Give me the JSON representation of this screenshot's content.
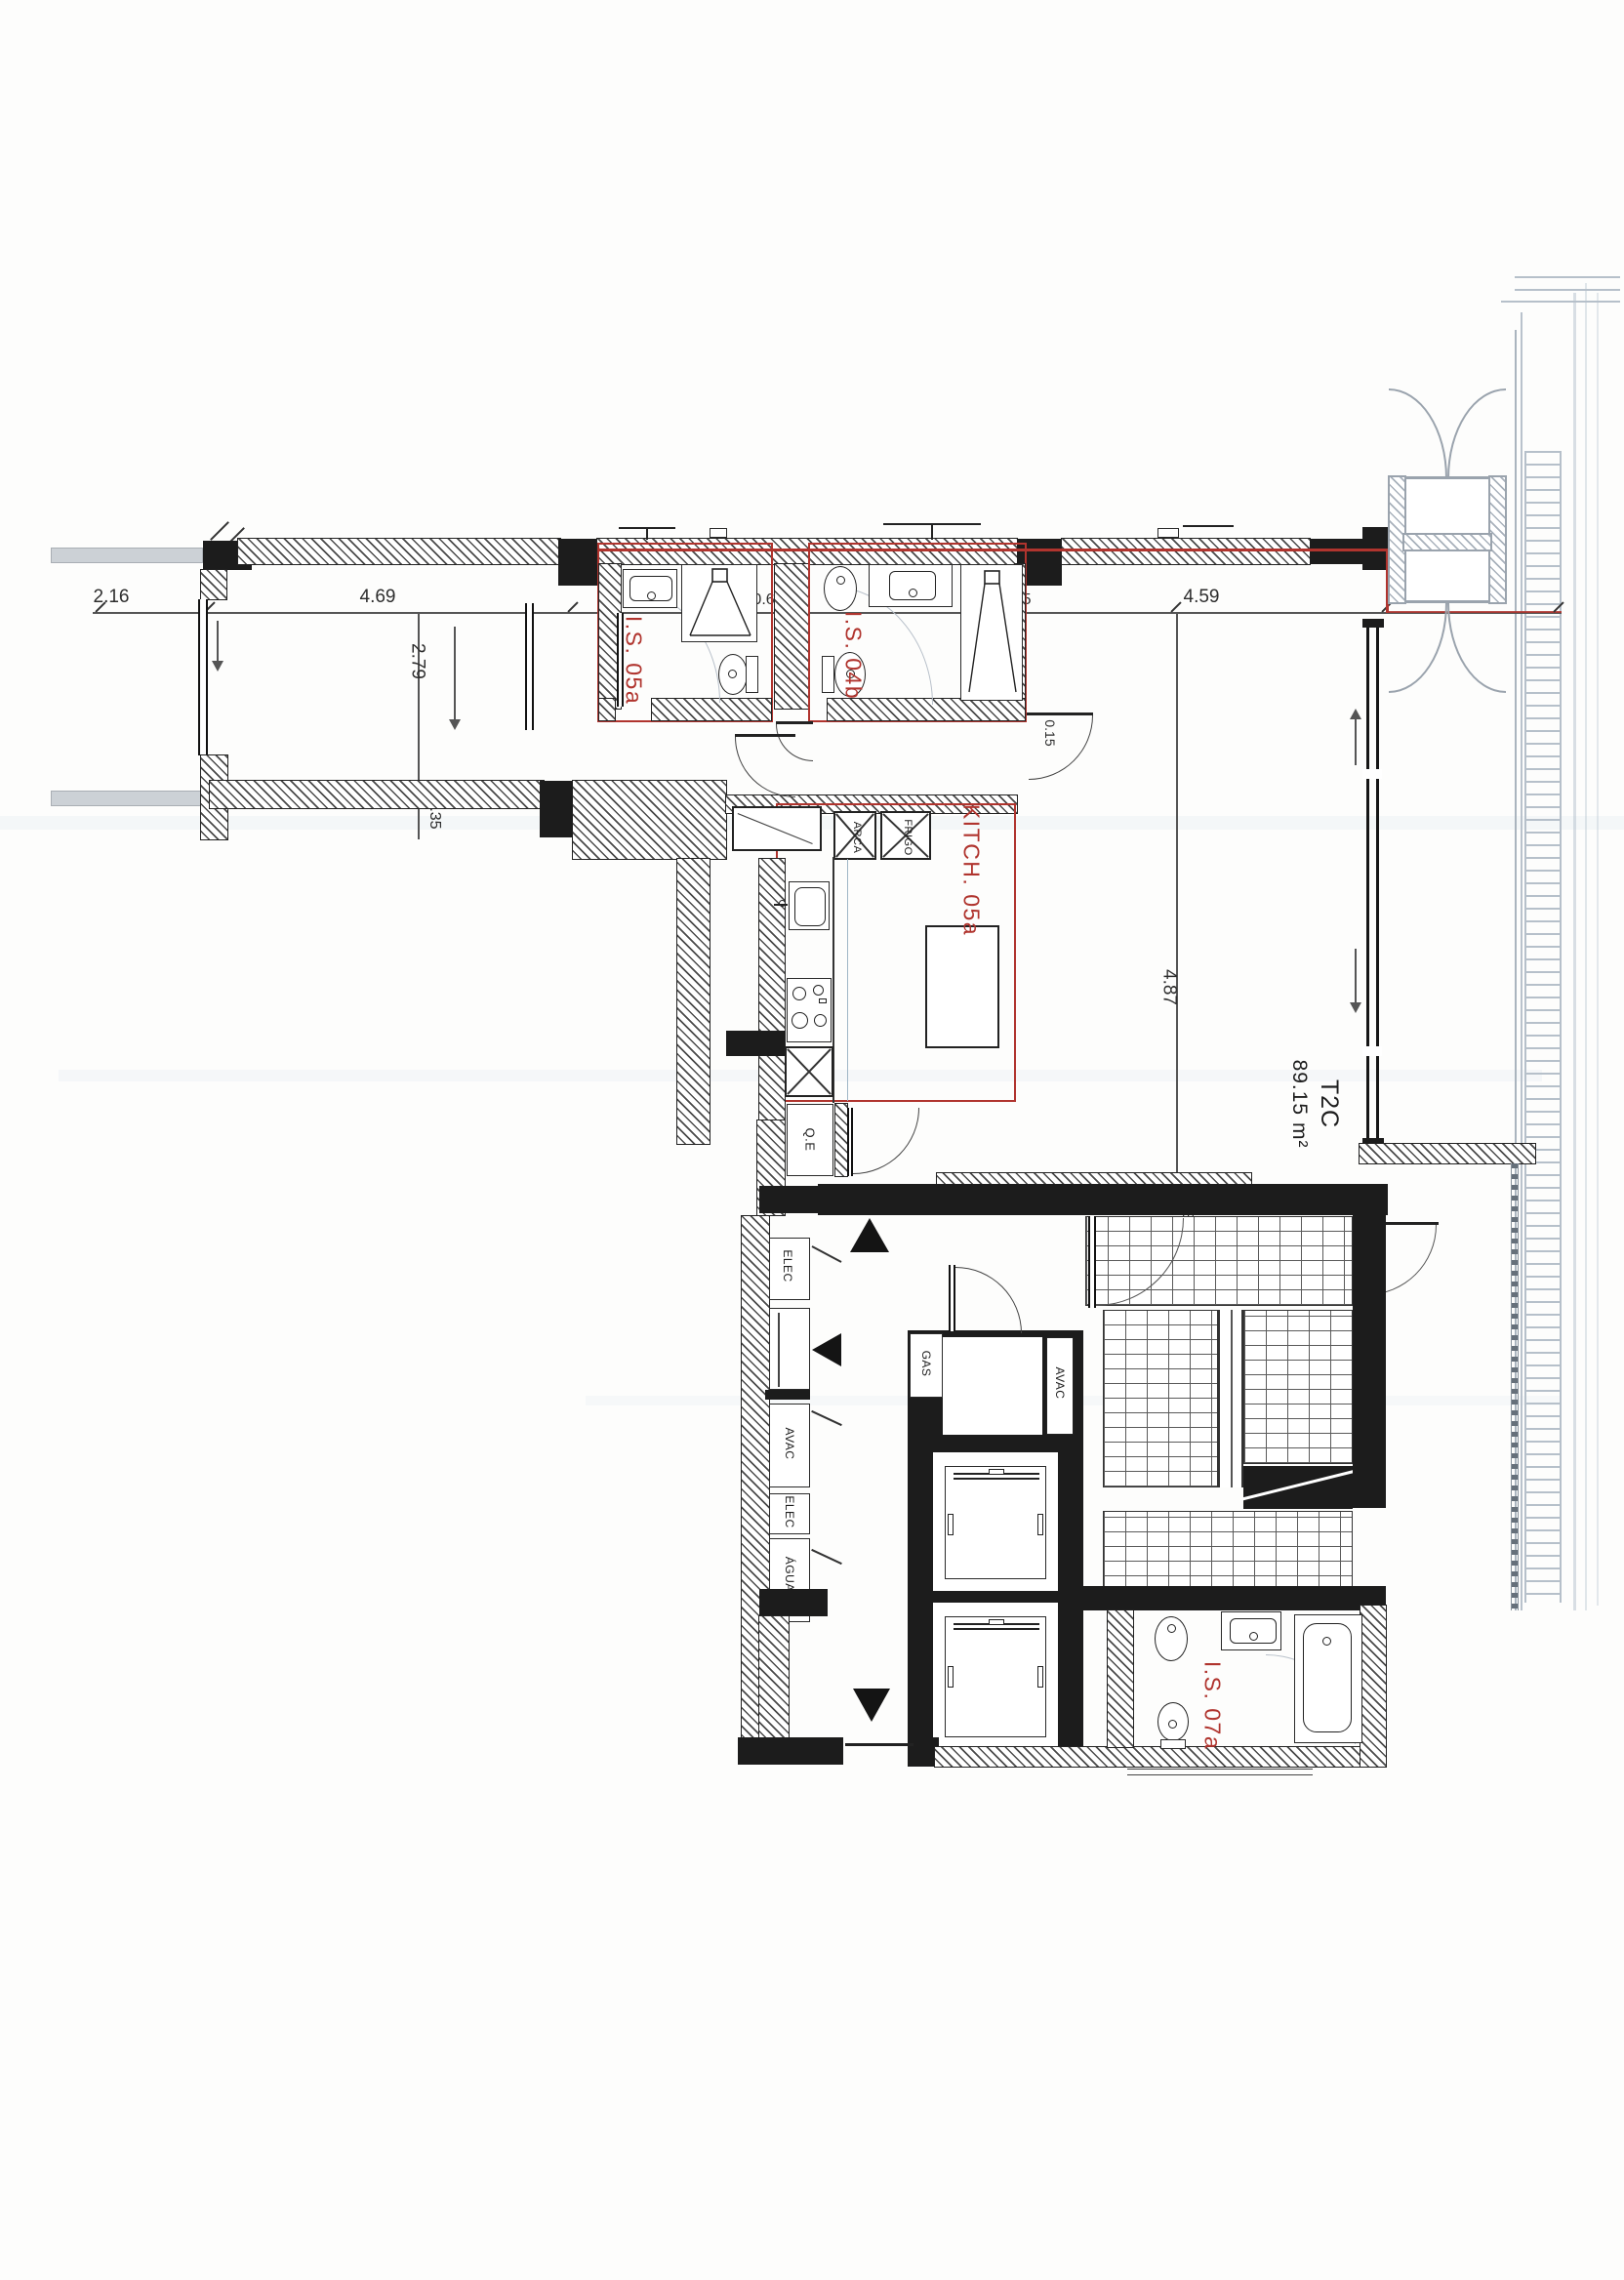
{
  "plan": {
    "rooms": {
      "is05a": "I.S. 05a",
      "is04b": "I.S. 04b",
      "kitchen": "KITCH. 05a",
      "is07a": "I.S. 07a",
      "unit_type": "T2C",
      "unit_area": "89.15 m²"
    },
    "shafts": {
      "qe": "Q.E",
      "gas": "GAS",
      "elec_upper": "ELEC",
      "elec_lower": "ELEC",
      "avac_hall": "AVAC",
      "avac_stair": "AVAC",
      "aguas": "ÁGUAS"
    },
    "appliances": {
      "arca": "ARCA",
      "frigo": "FRIGO"
    },
    "dims": {
      "top": [
        "2.16",
        "4.69",
        "2.40",
        "0.62",
        "2.80",
        "0.15",
        "4.59",
        "2.16"
      ],
      "v279": "2.79",
      "v035": "0.35",
      "v487": "4.87",
      "v034": "0.34",
      "v015": "0.15"
    },
    "colors": {
      "boundary": "#b0342e",
      "wall": "#1c1c1c",
      "common": "#9aa3ad",
      "scan": "#b6c0ca"
    }
  }
}
